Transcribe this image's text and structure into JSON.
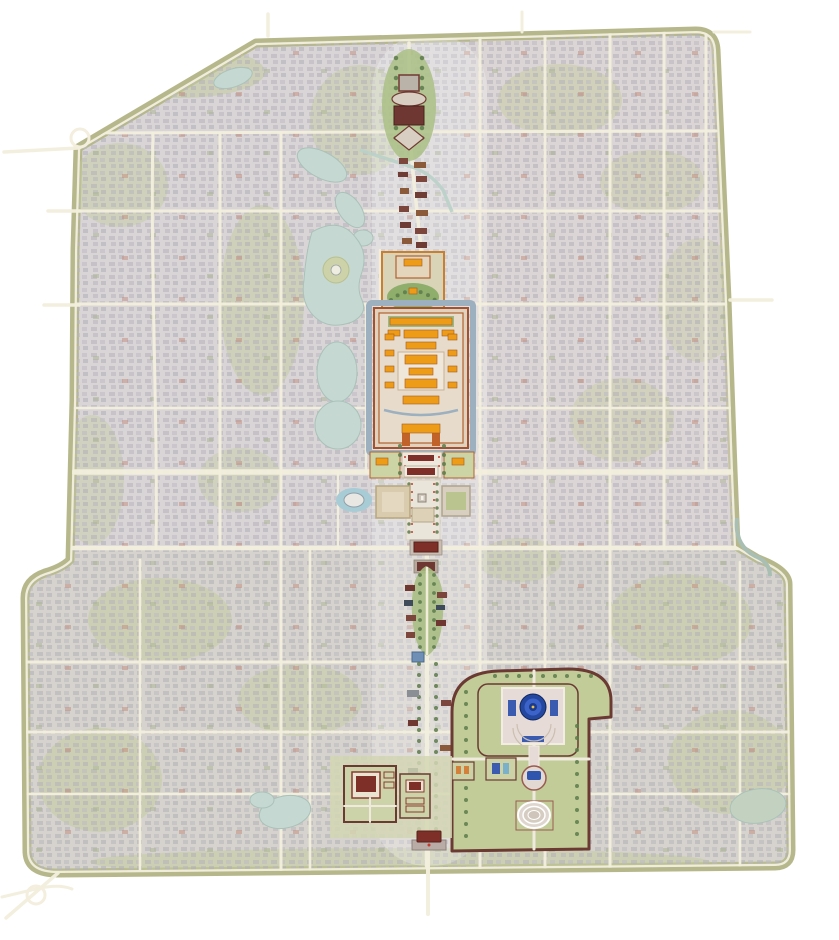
{
  "map": {
    "name": "Illustrated bird's-eye map of old Beijing with the highlighted north-south central axis",
    "colors": {
      "background": "#ffffff",
      "urban_base": "#d9d5d7",
      "urban_east_tint": "#e2d8d2",
      "road_cream": "#f3eedd",
      "city_wall_band": "#b6b88c",
      "park_green": "#c3cb9c",
      "tree_green": "#5c7a4a",
      "water": "#c6d8d2",
      "palace_moat_blue": "#9db0bf",
      "palace_roof_orange": "#ed9c17",
      "palace_wall_red": "#a6502e",
      "temple_wall_maroon": "#6b3a33",
      "temple_roof_blue": "#24479f",
      "gate_roof_red": "#7e2f28",
      "plaza_pale": "#eae5da",
      "flag_red": "#c23b2e",
      "hutong_house_gray": "#b6b3ba"
    },
    "features": [
      "city-outline",
      "ring-road",
      "hutong-blocks",
      "road-network",
      "lake-jishuitan",
      "lake-shichahai",
      "lake-beihai",
      "jade-island",
      "lake-zhonghai",
      "lake-nanhai",
      "lake-taoranting",
      "lake-longtan",
      "east-moat-river",
      "jade-river-stream",
      "bell-tower",
      "drum-tower",
      "central-axis-road",
      "axis-shops",
      "jingshan-park",
      "forbidden-city",
      "forbidden-city-moat",
      "meridian-gate",
      "duanmen-gate",
      "tiananmen-gate",
      "zhongshan-park",
      "workers-cultural-palace",
      "tiananmen-square",
      "monument-to-peoples-heroes",
      "mao-mausoleum",
      "great-hall-of-the-people",
      "national-museum",
      "ncpa-opera-house",
      "zhengyangmen-gate",
      "arrow-tower",
      "qianmen-street",
      "tianqiao-building",
      "temple-of-heaven",
      "hall-of-prayer-for-good-harvests",
      "imperial-vault-of-heaven",
      "circular-mound-altar",
      "zhaigong-palace",
      "xiannongtan-temple",
      "yongdingmen-gate",
      "southern-interchange"
    ]
  }
}
